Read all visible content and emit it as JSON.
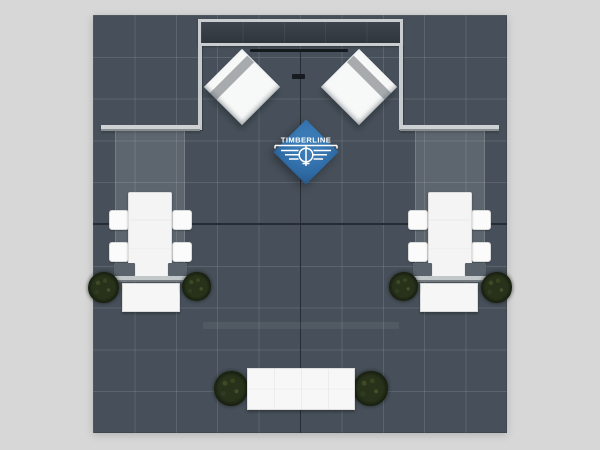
{
  "scene": {
    "description": "Top-down plan render of an island trade-show exhibit booth on a dark tiled floor",
    "background_color": "#d7d7d7",
    "floor": {
      "color": "#47505a",
      "grid_line_color": "#5b646e",
      "grid_columns": 10,
      "grid_rows": 10,
      "seam_color": "#272d34"
    },
    "colors": {
      "accent_blue": "#2f6ca6",
      "wall_gray": "#cdd1d4",
      "header_interior": "#333a42",
      "tower_white": "#f7f8f8",
      "tower_stripe": "#a7abae",
      "furniture_white": "#f5f6f5",
      "chair_block_gray": "#5a626b",
      "plant_green": "#28321a"
    },
    "objects": {
      "back_header": "framed hanging header",
      "towers": [
        "left rotated fabric tower",
        "right rotated fabric tower"
      ],
      "hanging_sign": "blue diamond logo sign",
      "conference_sets": 2,
      "chairs_per_table": 4,
      "storage_counters": 2,
      "front_counter": 1,
      "planters": 6
    }
  },
  "logo": {
    "brand": "TIMBERLINE"
  }
}
